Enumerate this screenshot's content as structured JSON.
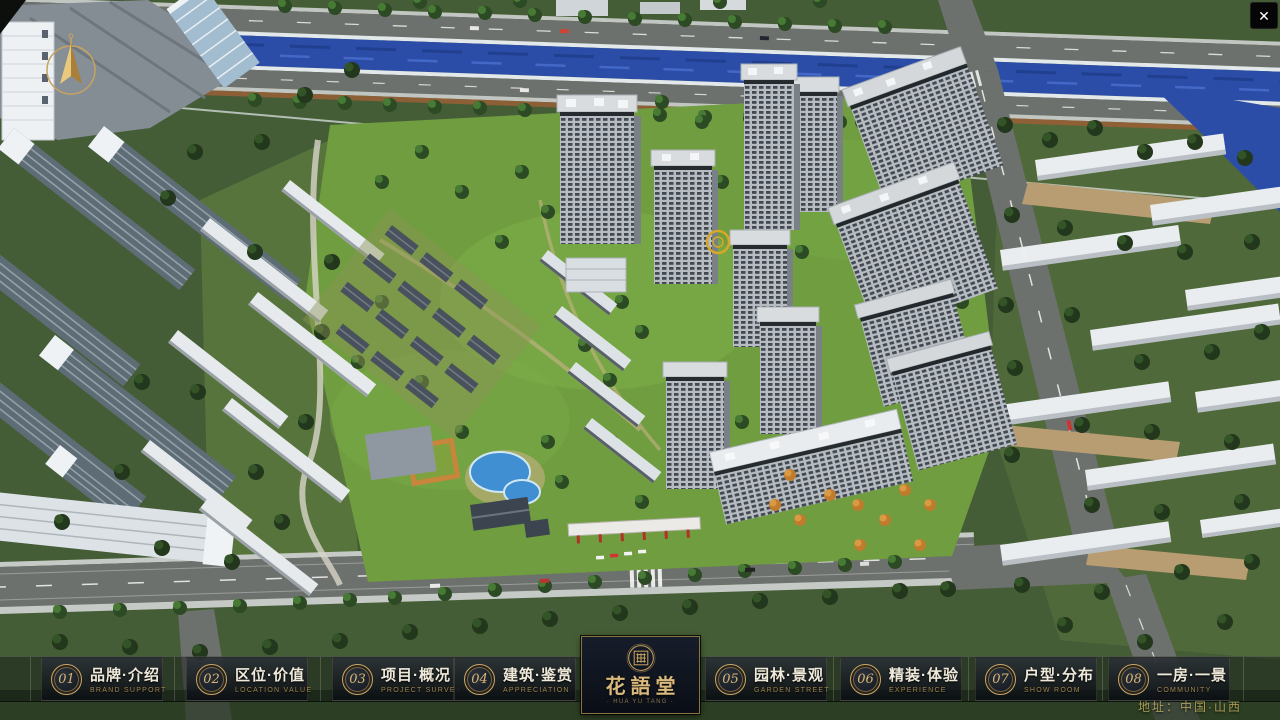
{
  "app": {
    "close_glyph": "✕"
  },
  "nav": {
    "items": [
      {
        "num": "01",
        "cn": "品牌·介绍",
        "en": "BRAND SUPPORT"
      },
      {
        "num": "02",
        "cn": "区位·价值",
        "en": "LOCATION VALUE"
      },
      {
        "num": "03",
        "cn": "项目·概况",
        "en": "PROJECT SURVEY"
      },
      {
        "num": "04",
        "cn": "建筑·鉴赏",
        "en": "APPRECIATION"
      },
      {
        "num": "05",
        "cn": "园林·景观",
        "en": "GARDEN STREET"
      },
      {
        "num": "06",
        "cn": "精装·体验",
        "en": "EXPERIENCE"
      },
      {
        "num": "07",
        "cn": "户型·分布",
        "en": "SHOW ROOM"
      },
      {
        "num": "08",
        "cn": "一房·一景",
        "en": "COMMUNITY"
      }
    ]
  },
  "logo": {
    "title": "花語堂",
    "tagline": "· HUA YU TANG ·"
  },
  "footer": {
    "address": "地址：中国·山西"
  },
  "colors": {
    "accent_gold": "#c9a667",
    "bar_bg": "#0a0d12",
    "river_blue": "#2b4da8",
    "lawn_green": "#6f9d3f"
  }
}
